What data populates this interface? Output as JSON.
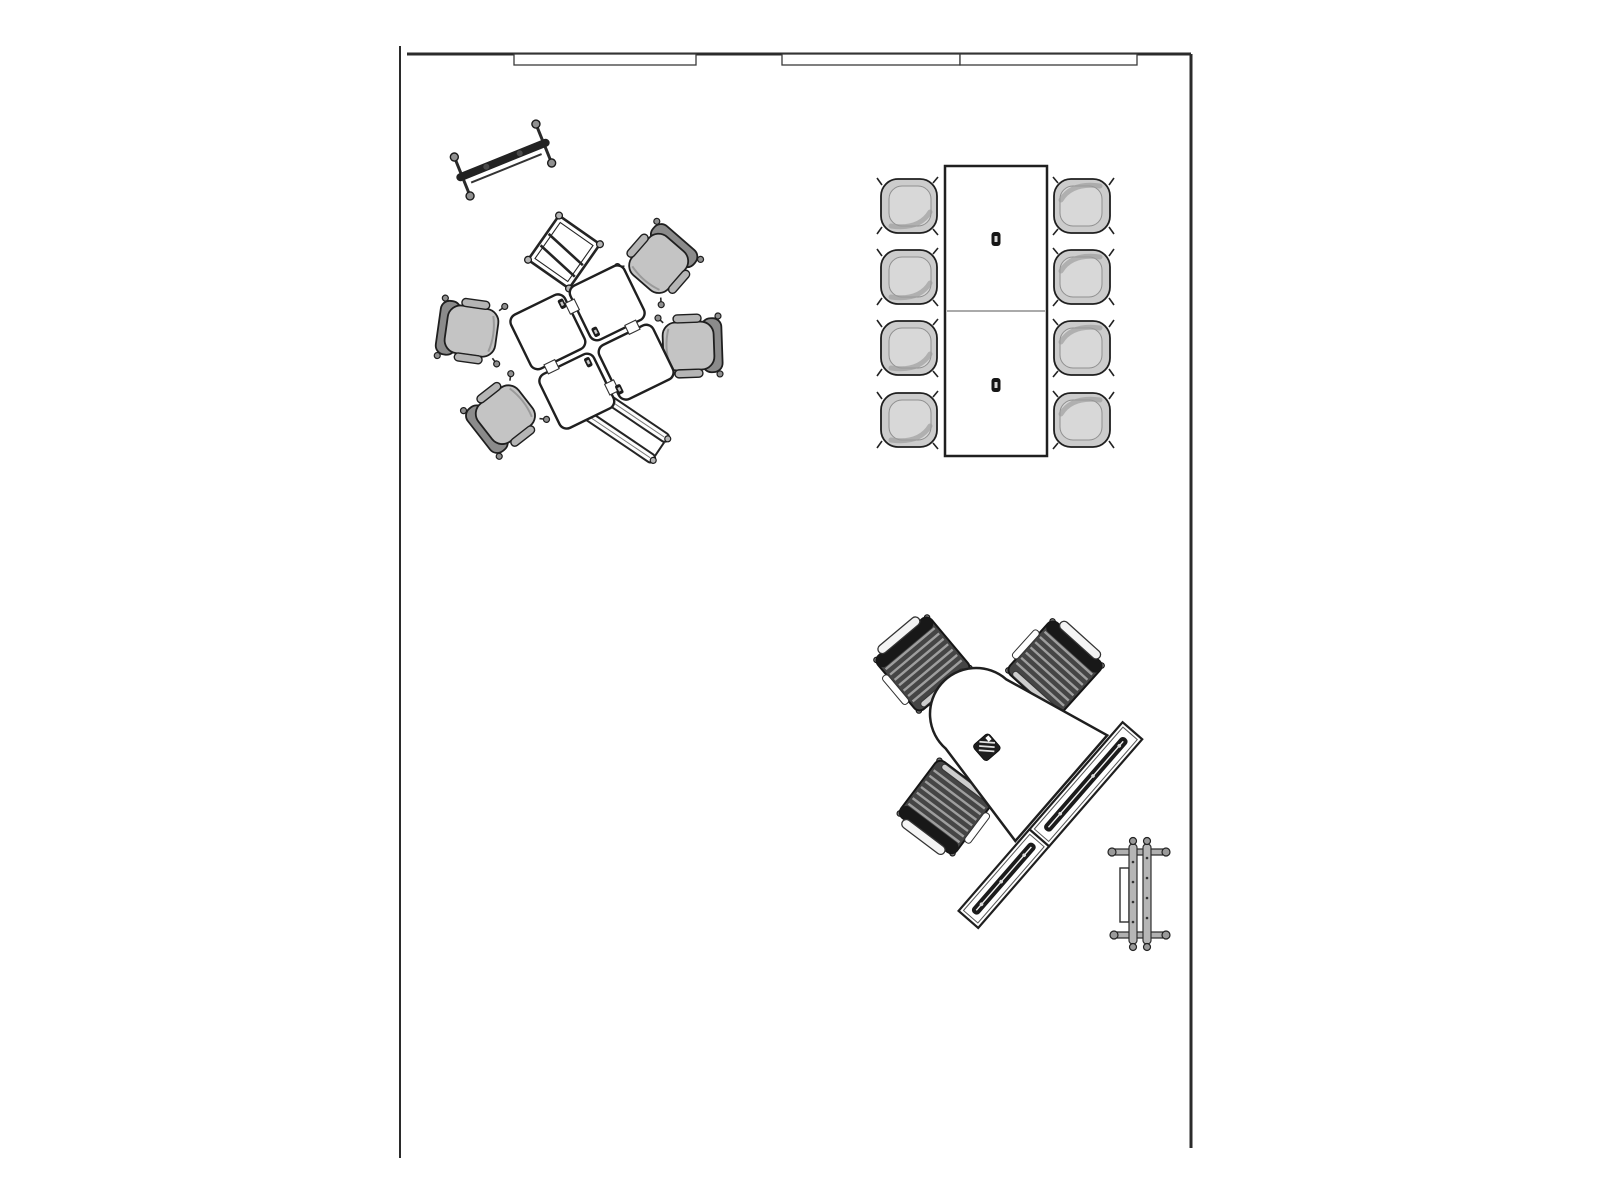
{
  "meta": {
    "title": "Office furniture floor plan - top view",
    "canvas": {
      "width": 1600,
      "height": 1200
    }
  },
  "colors": {
    "background": "#ffffff",
    "outline": "#1f1f1f",
    "wall": "#2b2b2b",
    "seat-light": "#c4c4c4",
    "seat-back": "#8b8b8b",
    "arm": "#b5b5b5",
    "shell": "#cccccc",
    "stripe-base": "#454545",
    "stripe-line": "#9e9e9e",
    "metal": "#b0b0b0",
    "accessory-dark": "#1c1c1c"
  },
  "floorplan": {
    "walls": [
      {
        "name": "wall-top",
        "x1": 407,
        "y1": 54,
        "x2": 1191,
        "y2": 54,
        "thickness": 3
      },
      {
        "name": "wall-right",
        "x1": 1191,
        "y1": 54,
        "x2": 1191,
        "y2": 1148,
        "thickness": 3
      },
      {
        "name": "wall-left",
        "x1": 400,
        "y1": 46,
        "x2": 400,
        "y2": 1158,
        "thickness": 2
      }
    ],
    "windows": [
      {
        "name": "window-panel-1",
        "x": 514,
        "y": 54,
        "width": 182,
        "height": 11
      },
      {
        "name": "window-panel-2",
        "x": 782,
        "y": 54,
        "width": 178,
        "height": 11
      },
      {
        "name": "window-panel-3",
        "x": 960,
        "y": 54,
        "width": 177,
        "height": 11
      }
    ],
    "furniture": [
      {
        "name": "mobile-rack",
        "symbol": "rack",
        "x": 503,
        "y": 160,
        "rotation": -22
      },
      {
        "name": "folded-easel-frame",
        "symbol": "folded-frame",
        "x": 564,
        "y": 252,
        "rotation": 35
      },
      {
        "name": "folded-table-frame",
        "symbol": "folded-frame-long",
        "x": 624,
        "y": 425,
        "rotation": 34
      },
      {
        "name": "task-chair-1",
        "symbol": "task-chair",
        "x": 659,
        "y": 263,
        "rotation": 41
      },
      {
        "name": "task-chair-2",
        "symbol": "task-chair",
        "x": 471,
        "y": 331,
        "rotation": -82
      },
      {
        "name": "task-chair-3",
        "symbol": "task-chair",
        "x": 689,
        "y": 346,
        "rotation": 88
      },
      {
        "name": "task-chair-4",
        "symbol": "task-chair",
        "x": 505,
        "y": 415,
        "rotation": -128
      },
      {
        "name": "collaboration-table-cluster",
        "symbol": "table-cluster",
        "x": 592,
        "y": 347,
        "rotation": -26
      },
      {
        "name": "conference-chair-1",
        "symbol": "conf-chair",
        "x": 909,
        "y": 206,
        "rotation": -90
      },
      {
        "name": "conference-chair-2",
        "symbol": "conf-chair",
        "x": 909,
        "y": 277,
        "rotation": -90
      },
      {
        "name": "conference-chair-3",
        "symbol": "conf-chair",
        "x": 909,
        "y": 348,
        "rotation": -90
      },
      {
        "name": "conference-chair-4",
        "symbol": "conf-chair",
        "x": 909,
        "y": 420,
        "rotation": -90
      },
      {
        "name": "conference-chair-5",
        "symbol": "conf-chair",
        "x": 1082,
        "y": 206,
        "rotation": 90
      },
      {
        "name": "conference-chair-6",
        "symbol": "conf-chair",
        "x": 1082,
        "y": 277,
        "rotation": 90
      },
      {
        "name": "conference-chair-7",
        "symbol": "conf-chair",
        "x": 1082,
        "y": 348,
        "rotation": 90
      },
      {
        "name": "conference-chair-8",
        "symbol": "conf-chair",
        "x": 1082,
        "y": 420,
        "rotation": 90
      },
      {
        "name": "conference-table",
        "symbol": "conference-table",
        "x": 996,
        "y": 311,
        "rotation": 0
      },
      {
        "name": "tablet-chair-1",
        "symbol": "training-chair",
        "x": 923,
        "y": 664,
        "rotation": -40
      },
      {
        "name": "tablet-chair-2",
        "symbol": "training-chair",
        "x": 1055,
        "y": 668,
        "rotation": 42
      },
      {
        "name": "tablet-chair-3",
        "symbol": "training-chair",
        "x": 946,
        "y": 807,
        "rotation": -143
      },
      {
        "name": "bullet-training-desk",
        "symbol": "bullet-desk",
        "x": 976,
        "y": 714,
        "rotation": 41
      },
      {
        "name": "mobile-cart",
        "symbol": "cart",
        "x": 1139,
        "y": 894,
        "rotation": 0
      }
    ]
  }
}
